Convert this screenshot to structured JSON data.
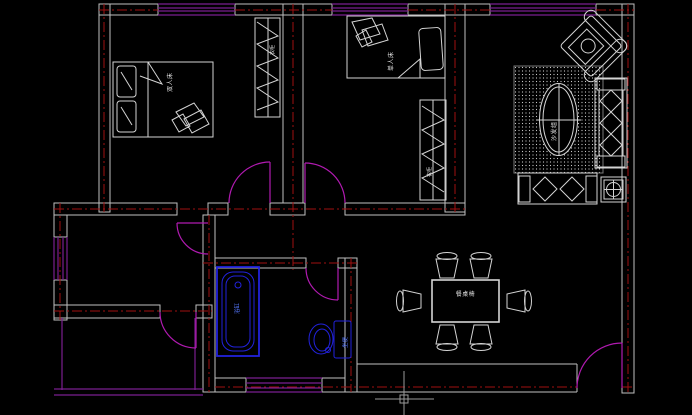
{
  "app": {
    "name": "cad-floorplan-canvas",
    "description": "Apartment floor plan line drawing on black CAD canvas with crosshair cursor"
  },
  "colors": {
    "background": "#000000",
    "wall": "#bfbfbf",
    "centerline": "#a01010",
    "window": "#7a1f8f",
    "door": "#b01ab0",
    "furniture": "#d4d4d4",
    "fixture": "#2222dd",
    "fixture_label": "#5577ff",
    "label": "#e0e0e0",
    "cursor": "#9a9a9a",
    "carpet_dot": "#cccccc"
  },
  "labels": {
    "bedroom1_bed": "双人床",
    "bedroom1_closet": "衣柜",
    "bedroom2_bed": "单人床",
    "bedroom2_closet": "衣柜",
    "living_sofa_rug": "沙发组",
    "dining_table": "餐桌椅",
    "bathtub": "浴缸",
    "toilet": "坐便"
  }
}
